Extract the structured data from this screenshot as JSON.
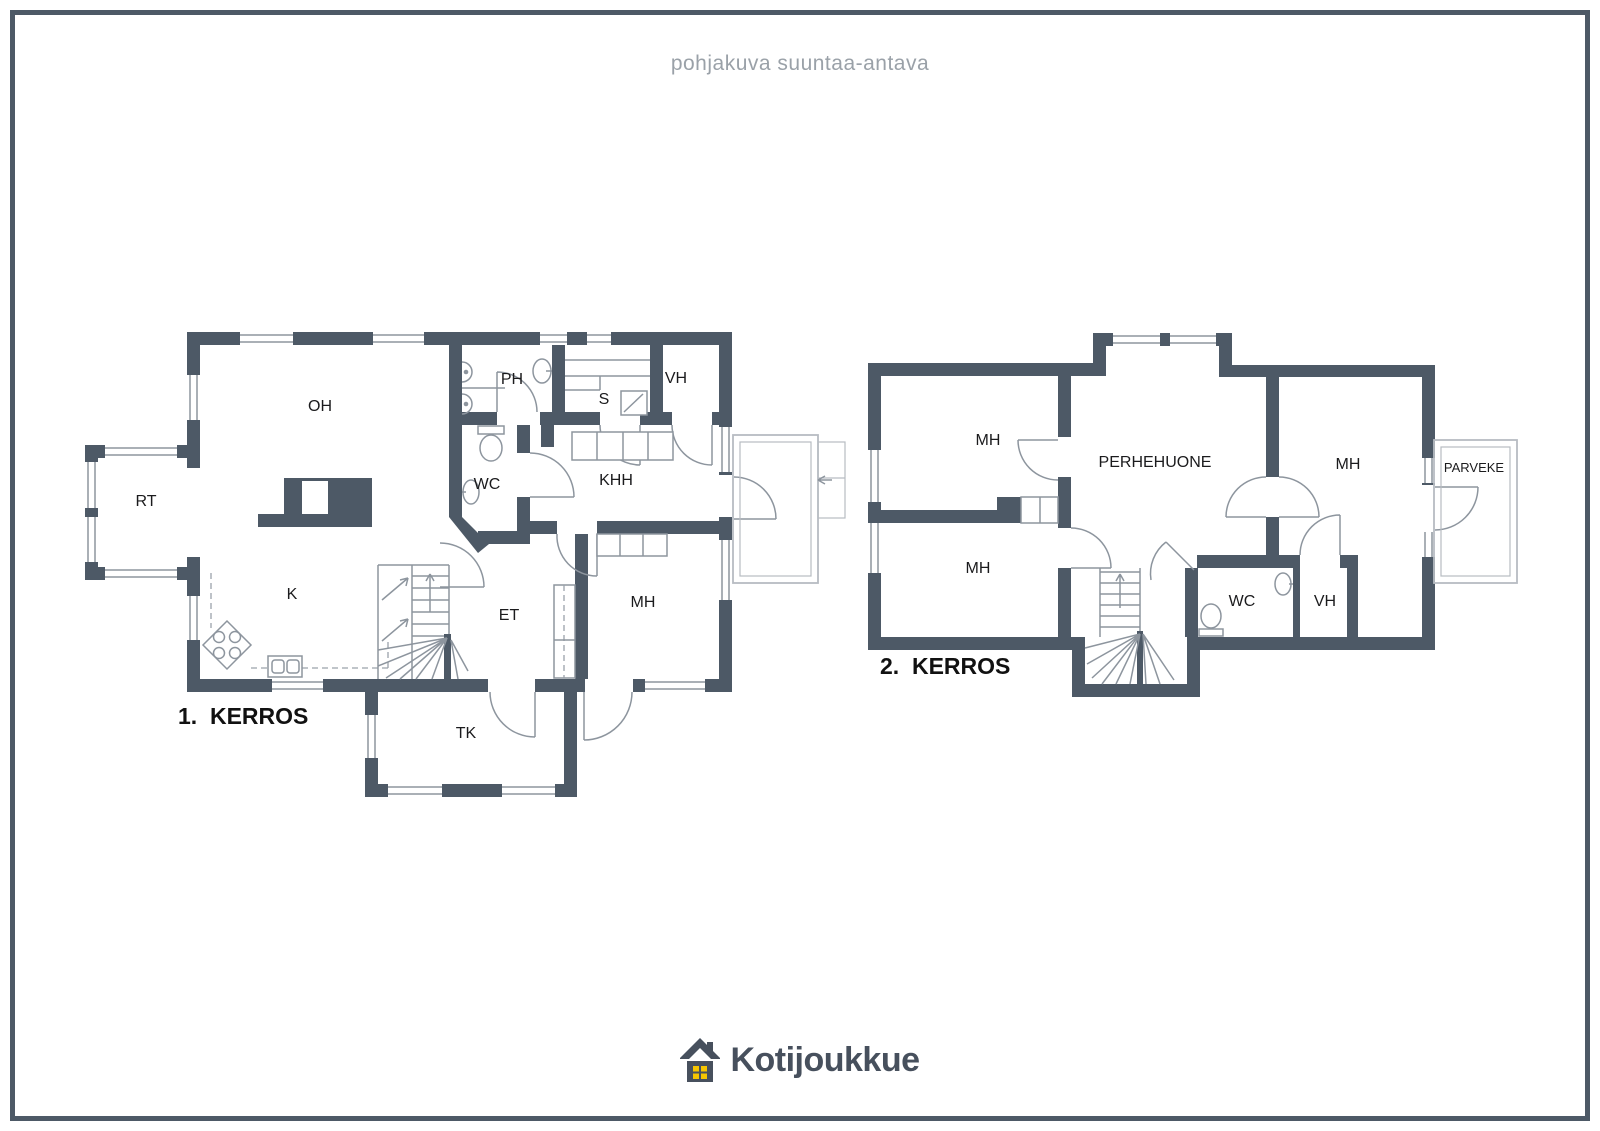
{
  "page": {
    "disclaimer": "pohjakuva suuntaa-antava",
    "background": "#ffffff",
    "border_color": "#4d5966"
  },
  "colors": {
    "wall": "#4d5966",
    "thin_line": "#8d959e",
    "terrace_line": "#b7bcc2",
    "label_text": "#1b1b1d",
    "disclaimer_text": "#9aa1a8",
    "logo_text": "#47505d",
    "logo_window_yellow": "#f6c500"
  },
  "floor1": {
    "title": "1.  KERROS",
    "rooms": [
      {
        "label": "OH"
      },
      {
        "label": "RT"
      },
      {
        "label": "PH"
      },
      {
        "label": "S"
      },
      {
        "label": "VH"
      },
      {
        "label": "WC"
      },
      {
        "label": "KHH"
      },
      {
        "label": "ET"
      },
      {
        "label": "MH"
      },
      {
        "label": "K"
      },
      {
        "label": "TK"
      }
    ]
  },
  "floor2": {
    "title": "2.  KERROS",
    "rooms": [
      {
        "label": "MH"
      },
      {
        "label": "MH"
      },
      {
        "label": "PERHEHUONE"
      },
      {
        "label": "MH"
      },
      {
        "label": "PARVEKE"
      },
      {
        "label": "WC"
      },
      {
        "label": "VH"
      }
    ]
  },
  "logo": {
    "text": "Kotijoukkue"
  }
}
